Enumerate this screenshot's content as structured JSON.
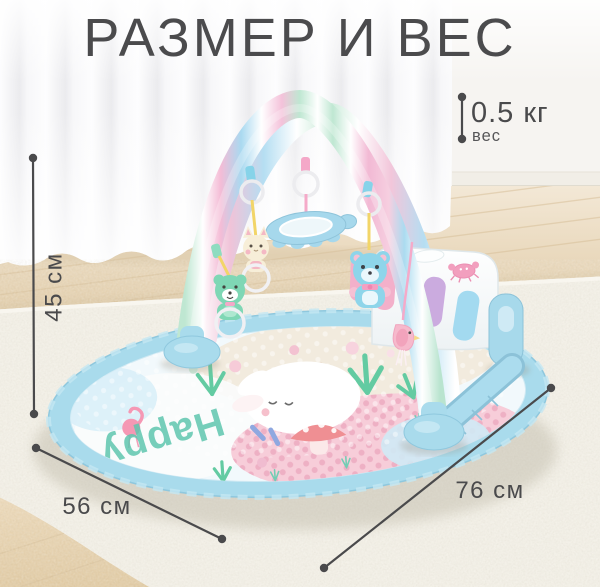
{
  "title": "РАЗМЕР И ВЕС",
  "weight": {
    "value": "0.5 кг",
    "label": "вес"
  },
  "dimensions": {
    "height": "45 см",
    "depth": "56 см",
    "width": "76 см"
  },
  "product": {
    "type": "baby play gym piano mat",
    "mat_word": "Happy"
  },
  "palette": {
    "annotation": "#4a4a4c",
    "mat_blue": "#a9dbec",
    "pastel_pink": "#f4bcd6",
    "pastel_mint": "#bfe7d2",
    "pastel_lilac": "#cbabdf",
    "carpet": "#f2efe6",
    "floor_wood": "#e8d6b6",
    "curtain": "#fbfbfd"
  }
}
